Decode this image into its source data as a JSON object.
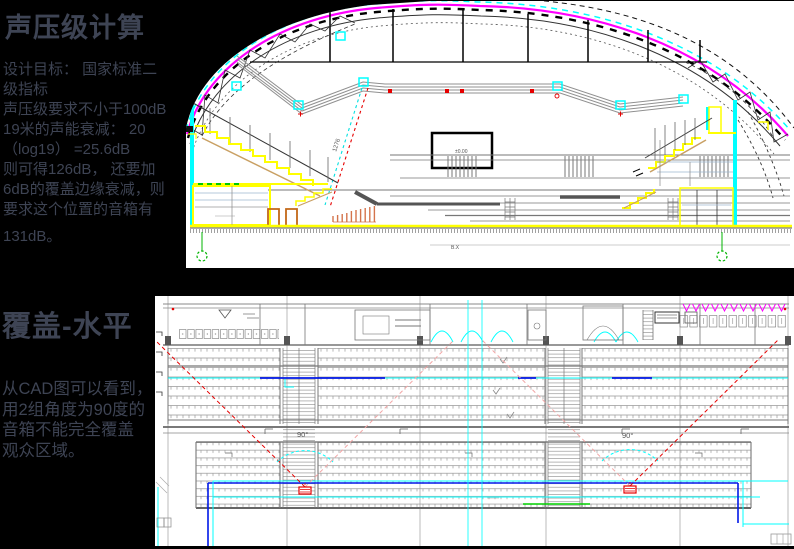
{
  "page": {
    "background": "#000000",
    "text_color": "#3E4454"
  },
  "colors": {
    "magenta": "#FF00FF",
    "cyan": "#00FFFF",
    "blue": "#0018E8",
    "yellow": "#FFFF00",
    "red": "#E60000",
    "green": "#00C800",
    "tan": "#C9A063",
    "salmon": "#D4744C"
  },
  "sections": {
    "spl": {
      "title": "声压级计算",
      "body": "设计目标： 国家标准二\n级指标\n声压级要求不小于100dB\n19米的声能衰减： 20\n（log19） =25.6dB\n则可得126dB， 还要加\n6dB的覆盖边缘衰减，则\n要求这个位置的音箱有",
      "body_end": "131dB。"
    },
    "coverage": {
      "title": "覆盖-水平",
      "body": "从CAD图可以看到，\n用2组角度为90度的\n音箱不能完全覆盖\n观众区域。"
    }
  },
  "section_drawing": {
    "label_slope": "1276",
    "scoreboard_label": "±0.00",
    "label_note": "B.X"
  },
  "plan_drawing": {
    "label_left_angle": "90°",
    "label_right_angle": "90°"
  }
}
